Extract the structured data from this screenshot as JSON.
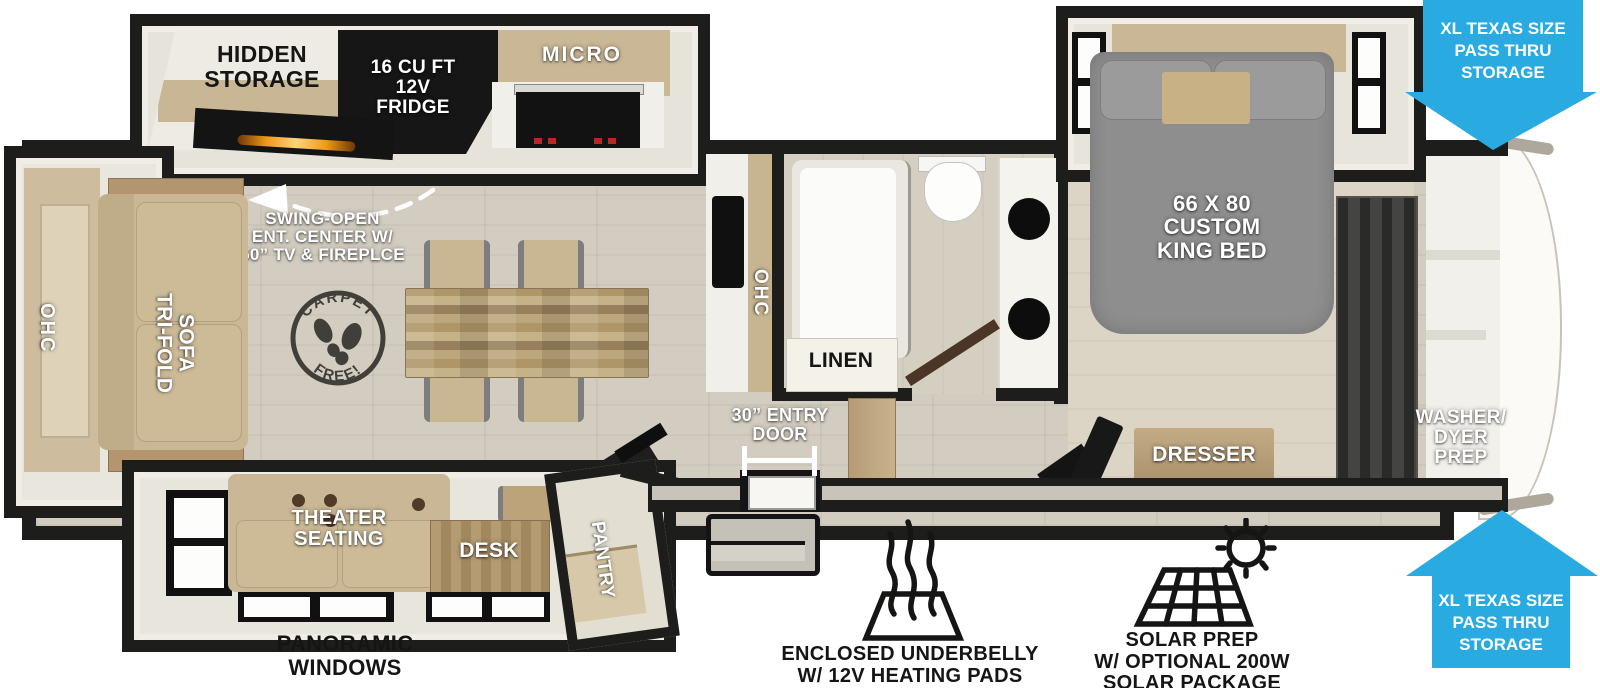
{
  "floorplan": {
    "kitchen_slide": {
      "hidden_storage": "HIDDEN\nSTORAGE",
      "fridge": "16 CU FT\n12V\nFRIDGE",
      "micro": "MICRO"
    },
    "kitchen": {
      "ohc": "OHC"
    },
    "rear_slide": {
      "ohc": "OHC",
      "sofa": "TRI-FOLD\nSOFA"
    },
    "bath": {
      "linen": "LINEN"
    },
    "bed_slide": {
      "king_bed": "66 X 80\nCUSTOM\nKING BED"
    },
    "bedroom": {
      "dresser": "DRESSER",
      "washer": "WASHER/\nDYER\nPREP"
    },
    "entry": {
      "door": "30” ENTRY\nDOOR"
    },
    "bottom_slide": {
      "theater": "THEATER\nSEATING",
      "desk": "DESK",
      "pantry": "PANTRY"
    },
    "callouts": {
      "swing_open": "SWING-OPEN\nENT. CENTER W/\n50” TV & FIREPLCE",
      "carpet_free_top": "CARPET",
      "carpet_free_bottom": "FREE!",
      "pass_thru_lines": [
        "XL TEXAS SIZE",
        "PASS THRU",
        "STORAGE"
      ],
      "panoramic": "PANORAMIC\nWINDOWS",
      "underbelly": "ENCLOSED UNDERBELLY\nW/ 12V HEATING PADS",
      "solar": "SOLAR PREP\nW/ OPTIONAL 200W\nSOLAR PACKAGE"
    },
    "colors": {
      "accent_blue": "#29ABE2",
      "wall": "#1D1D1B",
      "floor": "#D3CDC1",
      "wood": "#C7B592",
      "counter": "#F1EFE9",
      "bed_gray": "#8E8E8E"
    }
  }
}
